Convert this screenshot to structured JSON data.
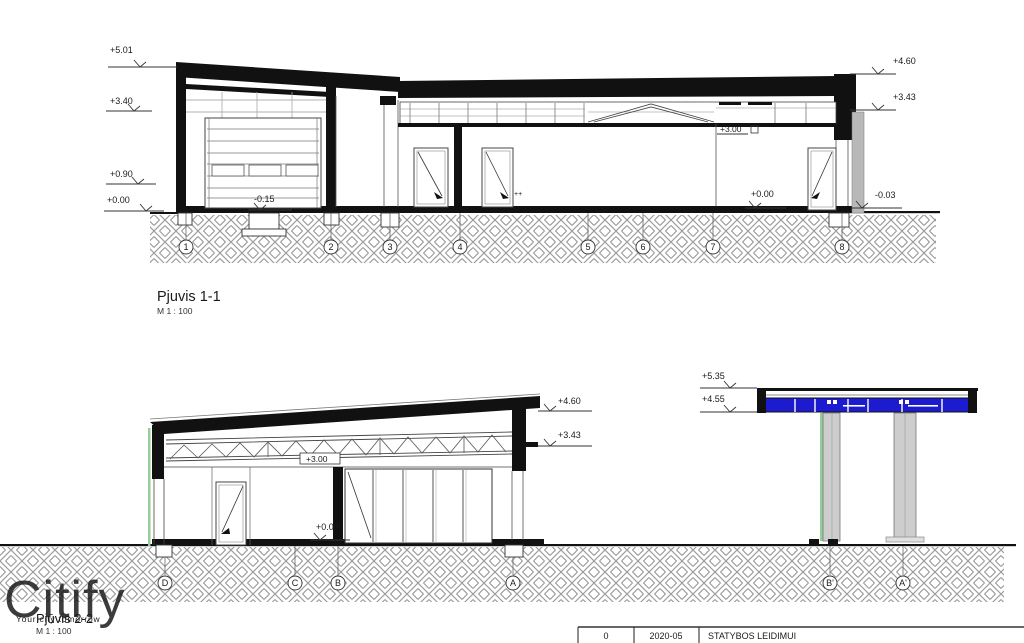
{
  "watermark": {
    "brand": "Citify",
    "tagline": "Your city tomorrow"
  },
  "section1": {
    "title": "Pjuvis 1-1",
    "scale": "M 1 : 100",
    "grids": [
      "1",
      "2",
      "3",
      "4",
      "5",
      "6",
      "7",
      "8"
    ],
    "levels": {
      "roof_high": "+5.01",
      "wall_mid": "+3.40",
      "sill": "+0.90",
      "zero": "+0.00",
      "pit": "-0.15",
      "parapet": "+4.60",
      "roof_edge": "+3.43",
      "interior_ceiling": "+3.00",
      "interior_floor": "+0.00",
      "grade": "-0.03"
    },
    "plus_marks": "++"
  },
  "section2": {
    "title": "Pjūvis 2-2",
    "scale": "M 1 : 100",
    "grids": [
      "D",
      "C",
      "B",
      "A"
    ],
    "levels": {
      "parapet": "+4.60",
      "roof_edge": "+3.43",
      "interior_ceiling": "+3.00",
      "interior_floor": "+0.00"
    }
  },
  "canopy": {
    "grids": [
      "B'",
      "A'"
    ],
    "levels": {
      "top": "+5.35",
      "fascia": "+4.55"
    }
  },
  "titleblock": {
    "revision": "0",
    "date": "2020-05",
    "stage": "STATYBOS LEIDIMUI"
  },
  "colors": {
    "blue": "#1d1bd0",
    "green": "#93cf96",
    "gray_wall": "#b8b8b8",
    "gray_column": "#cdcdcd",
    "hatch": "#9c9c9c",
    "watermark": "#9b9b9b"
  }
}
